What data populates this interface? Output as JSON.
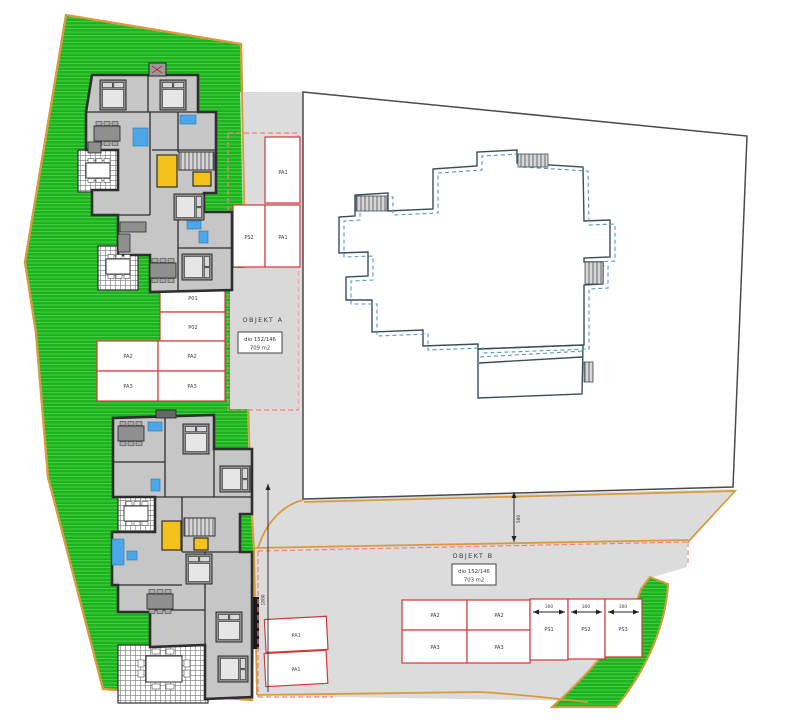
{
  "objekt_a": {
    "title": "OBJEKT A",
    "parcel": "dio 152/146",
    "area": "709 m2"
  },
  "objekt_b": {
    "title": "OBJEKT B",
    "parcel": "dio 152/146",
    "area": "703 m2"
  },
  "parking_a": {
    "stalls_top": [
      "PA1",
      "PS2",
      "PA1"
    ],
    "stalls_col": [
      "P01",
      "P02"
    ],
    "stalls_grid": [
      "PA2",
      "PA2",
      "PA3",
      "PA3"
    ]
  },
  "parking_b": {
    "stalls_grid": [
      "PA2",
      "PA2",
      "PA3",
      "PA3"
    ],
    "stalls_ps": [
      "PS1",
      "PS2",
      "PS3"
    ],
    "ps_widths": [
      "300",
      "300",
      "300"
    ],
    "stalls_left": [
      "PA1",
      "PA1"
    ]
  },
  "dimensions": {
    "driveway_length": "1800",
    "road_width": "500"
  },
  "colors": {
    "green_area": "#1cb21c",
    "parcel_border": "#d79b3e",
    "road_gray": "#dcdcdc",
    "parking_red": "#cf3a3a",
    "boundary_dashed_red": "#f08080",
    "footprint_solid": "#3a4f5a",
    "footprint_dashed": "#5898ac",
    "elevator_yellow": "#f2c21a",
    "fixture_blue": "#4da6e8"
  }
}
